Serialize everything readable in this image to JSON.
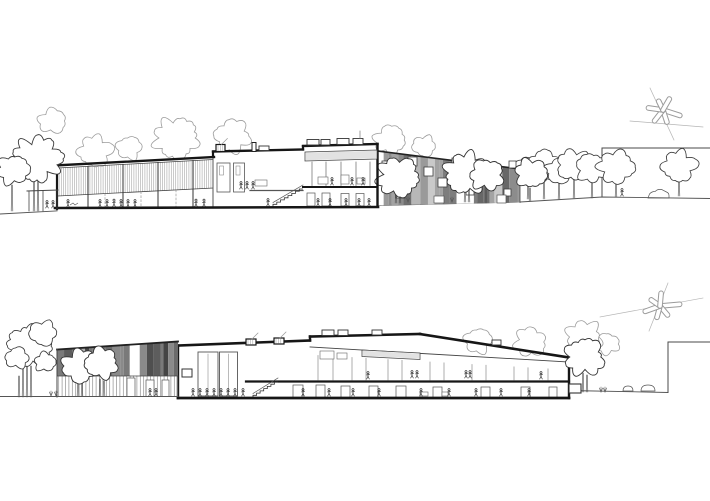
{
  "canvas": {
    "width": 710,
    "height": 501,
    "background": "#ffffff"
  },
  "palette": {
    "ink": "#161616",
    "wall": "#4a4a4a",
    "mid": "#555555",
    "thin": "#777777",
    "sketch": "#9c9c9c",
    "faint": "#b5b5b5",
    "louvre": "#adadad",
    "slat": "#909090",
    "figure": "#222222",
    "stripes_top": [
      "#6f6f6f",
      "#a3a3a3",
      "#c9c9c9",
      "#7d7d7d",
      "#b7b7b7",
      "#8c8c8c",
      "#d6d6d6",
      "#676767",
      "#9a9a9a"
    ],
    "stripes_bottom": [
      "#4f4f4f",
      "#6b6b6b",
      "#8a8a8a",
      "#454545",
      "#9e9e9e",
      "#5d5d5d",
      "#7a7a7a",
      "#b0b0b0"
    ]
  },
  "top": {
    "ground_left": [
      [
        0,
        214
      ],
      [
        56,
        211
      ]
    ],
    "ground_right": [
      [
        377,
        205.5
      ],
      [
        520,
        202
      ],
      [
        602,
        197
      ],
      [
        710,
        198.5
      ]
    ],
    "base": [
      [
        55,
        208
      ],
      [
        378,
        207
      ]
    ],
    "bg_trees": [
      [
        95,
        151,
        16,
        1
      ],
      [
        129,
        148,
        12,
        2
      ],
      [
        52,
        121,
        13,
        3
      ],
      [
        176,
        138,
        21,
        4
      ],
      [
        233,
        136,
        17,
        5
      ],
      [
        390,
        140,
        15,
        6
      ],
      [
        424,
        146,
        11,
        7
      ]
    ],
    "left_trees": [
      [
        37,
        159,
        23,
        8
      ],
      [
        13,
        170,
        15,
        9
      ]
    ],
    "left_trunks": [
      [
        34,
        211,
        182
      ],
      [
        38,
        211,
        179
      ],
      [
        12,
        211,
        185
      ]
    ],
    "pergola": {
      "beam": [
        [
          27,
          191
        ],
        [
          58,
          190
        ]
      ],
      "posts": [
        29,
        43,
        57
      ],
      "ground": 211
    },
    "hall": {
      "left_wall": [
        [
          57,
          209
        ],
        [
          57,
          165
        ]
      ],
      "roof": [
        [
          55,
          165.5
        ],
        [
          214,
          157
        ]
      ],
      "band_top": [
        [
          58,
          168
        ],
        [
          213,
          159.5
        ]
      ],
      "band_bot": [
        [
          58,
          196
        ],
        [
          213,
          188
        ]
      ],
      "mullions": [
        88,
        123,
        158,
        193
      ],
      "dashed": [
        105,
        141,
        176
      ],
      "divider": [
        [
          213,
          157
        ],
        [
          213,
          208
        ]
      ]
    },
    "bayA": {
      "parapet": [
        [
          213,
          157
        ],
        [
          213,
          151.5
        ]
      ],
      "roof": [
        [
          213,
          151.5
        ],
        [
          303,
          149.5
        ]
      ],
      "skylight": [
        216,
        144.5,
        9,
        7
      ],
      "chimney": [
        252,
        142.5,
        4,
        9
      ],
      "box": [
        259,
        146,
        10,
        4.5
      ],
      "tall_rects": [
        [
          217,
          163,
          13,
          29
        ],
        [
          233.5,
          163,
          11,
          29
        ]
      ],
      "inner_rects": [
        [
          219.5,
          166,
          4,
          9
        ],
        [
          236,
          166,
          4,
          9
        ]
      ],
      "floor_line": [
        [
          250,
          190.5
        ],
        [
          303,
          190.5
        ]
      ],
      "shelf": [
        255,
        180,
        12,
        6
      ],
      "stair": {
        "x0": 303,
        "y0": 189,
        "x1": 273,
        "y1": 206.5,
        "n": 8
      }
    },
    "bayB": {
      "parapet": [
        [
          303,
          149.5
        ],
        [
          303,
          146
        ]
      ],
      "roof": [
        [
          303,
          146
        ],
        [
          377.5,
          144
        ]
      ],
      "right_wall": [
        [
          377.5,
          144
        ],
        [
          377.5,
          206.5
        ]
      ],
      "boxes": [
        [
          307,
          139.5,
          12,
          5.5
        ],
        [
          321,
          139.5,
          9,
          5.5
        ],
        [
          337,
          138.5,
          12,
          6
        ],
        [
          353,
          138.5,
          10,
          6
        ]
      ],
      "antenna": [
        [
          360,
          131
        ],
        [
          360,
          138.5
        ]
      ],
      "tick_top": [
        [
          305,
          152
        ],
        [
          377,
          150
        ]
      ],
      "tick_bot": [
        [
          305,
          161
        ],
        [
          377,
          159
        ]
      ],
      "mullions": [
        312,
        326,
        341,
        356,
        370
      ],
      "furniture": [
        [
          318,
          177,
          10,
          7
        ],
        [
          341,
          175,
          8,
          9
        ],
        [
          357,
          178,
          8,
          6
        ]
      ],
      "slab": [
        [
          303,
          187
        ],
        [
          377,
          187
        ]
      ],
      "doors": [
        [
          307,
          193,
          8,
          13
        ],
        [
          322,
          193,
          8,
          13
        ],
        [
          341,
          193.5,
          8,
          12.5
        ],
        [
          356,
          193.5,
          8,
          12.5
        ]
      ]
    },
    "facade": {
      "tl": [
        377.5,
        151
      ],
      "tr": [
        520,
        169
      ],
      "br": [
        520,
        202.5
      ],
      "bl": [
        377.5,
        205.5
      ],
      "conf": {
        "wmin": 3,
        "wmax": 9,
        "gap": 0.16,
        "seed": 5
      },
      "windows": [
        [
          382,
          161,
          10
        ],
        [
          382,
          178,
          10
        ],
        [
          396,
          189,
          9
        ],
        [
          408,
          157,
          9
        ],
        [
          424,
          167,
          9
        ],
        [
          438,
          178,
          9
        ],
        [
          452,
          158,
          8
        ],
        [
          466,
          187,
          8
        ],
        [
          478,
          167,
          8
        ],
        [
          493,
          177,
          8
        ],
        [
          504,
          189,
          7
        ],
        [
          509,
          161,
          7
        ]
      ],
      "base_rects": [
        [
          434,
          196,
          10,
          7
        ],
        [
          497,
          195,
          9,
          8
        ]
      ]
    },
    "facade_trees": [
      [
        398,
        177,
        20,
        10
      ],
      [
        467,
        173,
        21,
        11
      ],
      [
        487,
        175,
        16,
        12
      ],
      [
        531,
        173,
        15,
        13
      ]
    ],
    "facade_trunks": [
      [
        396,
        203,
        185
      ],
      [
        400,
        203,
        187
      ],
      [
        465,
        202,
        182
      ],
      [
        469,
        202,
        184
      ],
      [
        486,
        203,
        186
      ],
      [
        530,
        201,
        188
      ]
    ],
    "right_wall": {
      "top": [
        [
          602,
          148
        ],
        [
          710,
          148
        ]
      ],
      "edge": [
        [
          602,
          148
        ],
        [
          602,
          197
        ]
      ]
    },
    "right_trees": [
      [
        528,
        171,
        14,
        14
      ],
      [
        544,
        166,
        16,
        15
      ],
      [
        559,
        171,
        13,
        16
      ],
      [
        574,
        165,
        16,
        17
      ],
      [
        592,
        168,
        15,
        18
      ],
      [
        616,
        167,
        17,
        19
      ],
      [
        679,
        166,
        16,
        20
      ]
    ],
    "right_trunks": [
      [
        528,
        199,
        183
      ],
      [
        544,
        199,
        180
      ],
      [
        559,
        199,
        182
      ],
      [
        574,
        198,
        179
      ],
      [
        592,
        198,
        181
      ],
      [
        616,
        197,
        182
      ],
      [
        679,
        196,
        180
      ]
    ],
    "car": [
      648,
      191
    ],
    "figures_hall": [
      [
        68,
        207
      ],
      [
        100,
        207
      ],
      [
        107,
        207
      ],
      [
        114,
        206.5
      ],
      [
        121,
        207
      ],
      [
        128,
        207
      ],
      [
        135,
        207
      ],
      [
        196,
        206.5
      ],
      [
        204,
        206.5
      ],
      [
        47,
        208
      ],
      [
        53,
        208
      ]
    ],
    "figures_bayA_upper": [
      [
        241,
        189
      ],
      [
        247,
        189
      ],
      [
        253,
        189
      ]
    ],
    "figures_stair": [
      [
        268,
        206
      ]
    ],
    "figures_bayB_upper": [
      [
        332,
        185
      ],
      [
        352,
        185
      ],
      [
        363,
        185
      ]
    ],
    "figures_bayB_lower": [
      [
        318,
        206
      ],
      [
        330,
        206
      ],
      [
        346,
        206
      ],
      [
        359,
        206
      ],
      [
        369,
        206
      ]
    ],
    "figures_right": [
      [
        622,
        196
      ]
    ],
    "ground_mark": [
      74,
      204
    ],
    "sculpture": {
      "cx": 663,
      "cy": 110,
      "blades": [
        [
          18,
          20
        ],
        [
          72,
          15
        ],
        [
          128,
          16
        ],
        [
          188,
          17
        ],
        [
          244,
          12
        ],
        [
          300,
          15
        ]
      ],
      "lines": [
        [
          650,
          88,
          674,
          140
        ],
        [
          630,
          121,
          703,
          127
        ]
      ]
    }
  },
  "bottom": {
    "ground_left": [
      [
        0,
        396.5
      ],
      [
        178,
        396.5
      ]
    ],
    "ground_right": [
      [
        569,
        390.5
      ],
      [
        668,
        392.5
      ]
    ],
    "wall_edge": [
      [
        668,
        392.5
      ],
      [
        668,
        342
      ]
    ],
    "wall_top": [
      [
        668,
        342
      ],
      [
        710,
        342
      ]
    ],
    "bg_trees": [
      [
        478,
        341,
        13,
        21
      ],
      [
        530,
        342,
        15,
        22
      ],
      [
        584,
        337,
        17,
        23
      ],
      [
        608,
        344,
        11,
        24
      ]
    ],
    "left_tree_lobes": [
      [
        30,
        346,
        21,
        25
      ],
      [
        43,
        333,
        13,
        26
      ],
      [
        17,
        358,
        11,
        27
      ],
      [
        45,
        362,
        10,
        28
      ]
    ],
    "left_trunks": [
      [
        23,
        397,
        368
      ],
      [
        27,
        397,
        362
      ],
      [
        31,
        397,
        366
      ],
      [
        19,
        397,
        376
      ]
    ],
    "shrubs": [
      [
        51,
        396
      ],
      [
        56,
        396
      ],
      [
        601,
        392
      ],
      [
        605,
        392
      ]
    ],
    "facade": {
      "tl": [
        57,
        349.5
      ],
      "tr": [
        178,
        341.5
      ],
      "band_bottom": 376,
      "base": 397,
      "conf": {
        "wmin": 3,
        "wmax": 8,
        "gap": 0.1,
        "seed": 11
      },
      "doors": [
        [
          127,
          378,
          8,
          18.5
        ],
        [
          146,
          380,
          8,
          16.5
        ],
        [
          162,
          380,
          7,
          16.5
        ]
      ]
    },
    "facade_trees": [
      [
        80,
        366,
        17,
        29
      ],
      [
        102,
        363,
        16,
        30
      ]
    ],
    "facade_trunks": [
      [
        78,
        396,
        381
      ],
      [
        82,
        396,
        383
      ],
      [
        100,
        396,
        379
      ],
      [
        104,
        396,
        381
      ]
    ],
    "figures_facade": [
      [
        150,
        396
      ],
      [
        156,
        396
      ]
    ],
    "section": {
      "left_wall": [
        [
          178,
          398
        ],
        [
          178,
          345.5
        ]
      ],
      "roof1": [
        [
          178,
          345.5
        ],
        [
          310,
          340.5
        ]
      ],
      "step": [
        [
          310,
          340.5
        ],
        [
          310,
          336.5
        ]
      ],
      "roof2": [
        [
          310,
          336.5
        ],
        [
          420,
          334
        ]
      ],
      "slope": [
        [
          420,
          334
        ],
        [
          569,
          357.5
        ]
      ],
      "right_wall": [
        [
          569,
          357.5
        ],
        [
          569,
          398
        ]
      ],
      "base": [
        [
          178,
          398
        ],
        [
          569,
          398
        ]
      ],
      "skylights": [
        [
          246,
          339,
          10,
          6
        ],
        [
          274,
          338,
          10,
          6
        ]
      ],
      "roof_boxes": [
        [
          322,
          330,
          12,
          5.5
        ],
        [
          338,
          330,
          10,
          5.5
        ],
        [
          372,
          330,
          10,
          5
        ],
        [
          492,
          340,
          9,
          5
        ]
      ],
      "ceiling": [
        [
          310,
          347
        ],
        [
          569,
          362
        ]
      ],
      "tick_top": [
        [
          362,
          350
        ],
        [
          420,
          353
        ]
      ],
      "tick_bot": [
        [
          362,
          356.5
        ],
        [
          420,
          359.5
        ]
      ],
      "niche": [
        182,
        369,
        10,
        8
      ],
      "door_panels": [
        [
          198,
          352,
          20,
          44
        ],
        [
          219.5,
          352,
          18,
          44
        ]
      ],
      "upper_boxes": [
        [
          320,
          351,
          14,
          8
        ],
        [
          337,
          353,
          10,
          6
        ]
      ],
      "mullion_top": [
        [
          310,
          355
        ],
        [
          569,
          370
        ]
      ],
      "mullions": [
        318,
        333,
        352,
        366,
        388,
        402,
        430,
        444,
        472,
        486,
        514,
        528,
        548
      ],
      "slab": [
        [
          246,
          381.5
        ],
        [
          569,
          381.5
        ]
      ],
      "stair": {
        "x0": 278,
        "y0": 382,
        "x1": 253,
        "y1": 397.5,
        "n": 7
      },
      "doors": [
        [
          293,
          385,
          10,
          12.5
        ],
        [
          316,
          385,
          9,
          12.5
        ],
        [
          341,
          386,
          9,
          11.5
        ],
        [
          369,
          386,
          9,
          11.5
        ],
        [
          396,
          386,
          10,
          11.5
        ],
        [
          433,
          387,
          9,
          10.5
        ],
        [
          481,
          387,
          9,
          10.5
        ],
        [
          521,
          387,
          9,
          10.5
        ],
        [
          549,
          387,
          8,
          10.5
        ]
      ],
      "tables": [
        [
          420,
          392,
          8,
          4
        ],
        [
          442,
          392,
          6,
          4
        ]
      ],
      "out_box": [
        569,
        384,
        12,
        9
      ]
    },
    "figures_hall": [
      [
        193,
        396
      ],
      [
        200,
        396
      ],
      [
        207,
        396
      ],
      [
        214,
        396
      ],
      [
        221,
        396
      ],
      [
        228,
        396
      ],
      [
        235,
        396
      ],
      [
        243,
        396
      ]
    ],
    "figures_upper": [
      [
        368,
        379
      ],
      [
        412,
        378
      ],
      [
        417,
        378
      ],
      [
        466,
        378
      ],
      [
        470,
        378
      ],
      [
        541,
        379
      ]
    ],
    "figures_lower": [
      [
        303,
        396
      ],
      [
        329,
        396
      ],
      [
        353,
        396
      ],
      [
        379,
        396
      ],
      [
        421,
        396
      ],
      [
        449,
        396
      ],
      [
        476,
        396
      ],
      [
        501,
        396
      ],
      [
        529,
        396
      ]
    ],
    "front_tree": [
      [
        585,
        357,
        19,
        31
      ]
    ],
    "front_trunks": [
      [
        583,
        392,
        373
      ],
      [
        587,
        392,
        375
      ]
    ],
    "rocks": [
      [
        628,
        391,
        10,
        5
      ],
      [
        648,
        391,
        14,
        6
      ]
    ],
    "sculpture": {
      "cx": 660,
      "cy": 306,
      "blades": [
        [
          355,
          22
        ],
        [
          50,
          14
        ],
        [
          105,
          14
        ],
        [
          160,
          18
        ],
        [
          215,
          13
        ],
        [
          275,
          15
        ]
      ],
      "lines": [
        [
          600,
          317,
          703,
          298
        ],
        [
          668,
          283,
          649,
          331
        ]
      ]
    }
  }
}
